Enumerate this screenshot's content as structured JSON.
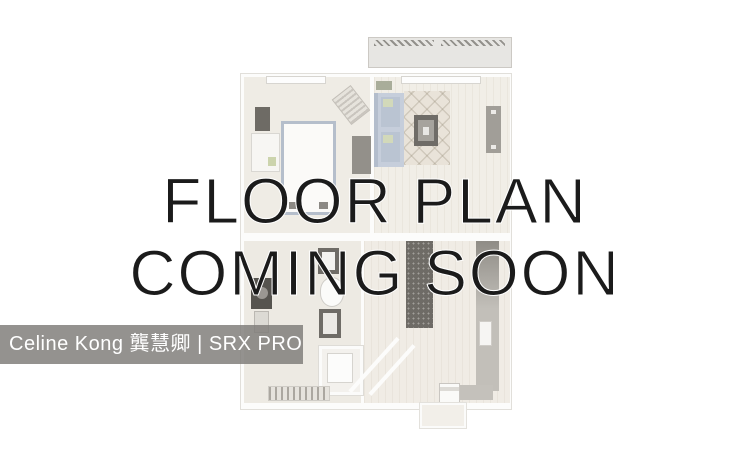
{
  "overlay": {
    "line1": "FLOOR PLAN",
    "line2": "COMING SOON"
  },
  "watermark": {
    "text": "Celine Kong 龔慧卿 | SRX PROPERTY"
  },
  "colors": {
    "overlay_text": "#1b1b1b",
    "watermark_bar": "#7f7d7a",
    "watermark_text": "#ffffff",
    "floorplan_floor": "#f0ece5",
    "floorplan_dark_furniture": "#6e6b66",
    "floorplan_sofa_blue": "#c6cedb",
    "floorplan_bed_trim_blue": "#b5becb"
  },
  "floorplan": {
    "rooms": [
      "balcony",
      "bedroom",
      "living-room",
      "bathroom",
      "closet",
      "kitchen",
      "entry"
    ]
  }
}
